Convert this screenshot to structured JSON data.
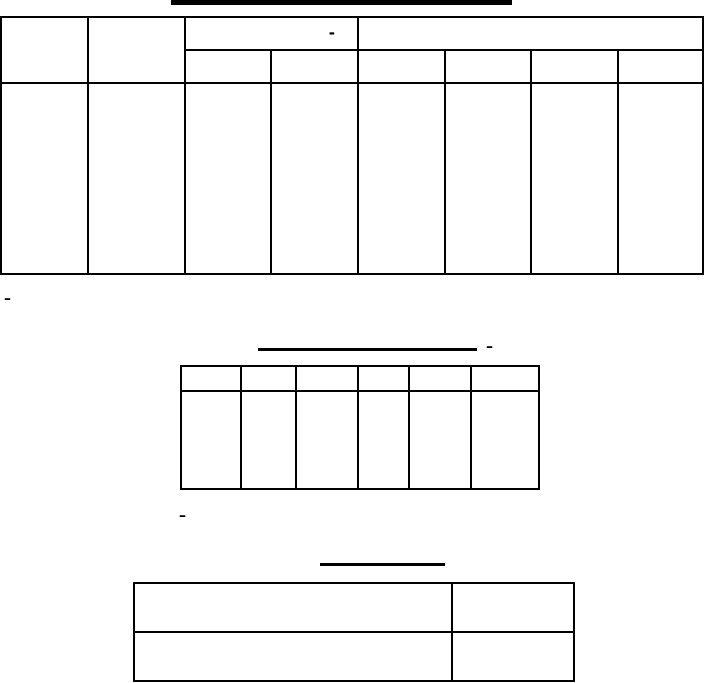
{
  "page": {
    "background_color": "#ffffff",
    "ink_color": "#000000"
  },
  "table1": {
    "group_header_dash": "-"
  },
  "annotations": {
    "dash_below_table1": "–",
    "dash_after_table2_title_underline": "–",
    "dash_below_table2": "–"
  }
}
